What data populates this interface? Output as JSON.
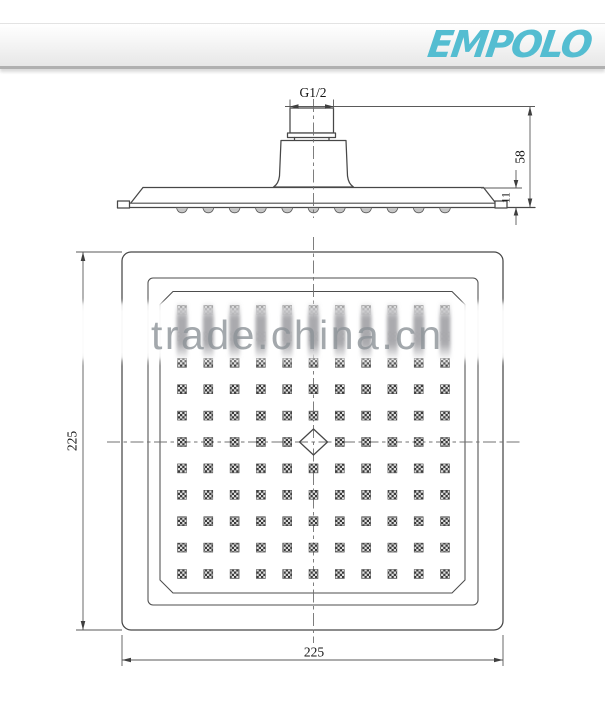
{
  "page": {
    "background": "#ffffff"
  },
  "header": {
    "logo_text": "EMPOLO",
    "logo_color": "#54bdd1"
  },
  "watermark": {
    "text": "trade.china.cn",
    "color": "#8d9398"
  },
  "side_view": {
    "thread_label": "G1/2",
    "height_label": "58",
    "thickness_label": "11"
  },
  "bottom_view": {
    "width_label": "225",
    "height_label": "225",
    "grid": {
      "rows": 11,
      "cols": 11,
      "x_start": 182,
      "y_start": 310,
      "dx": 26.3,
      "dy": 26.4,
      "nozzle_size": 9,
      "center_row": 5,
      "center_col": 5
    }
  },
  "drawing": {
    "line_color": "#474747"
  }
}
